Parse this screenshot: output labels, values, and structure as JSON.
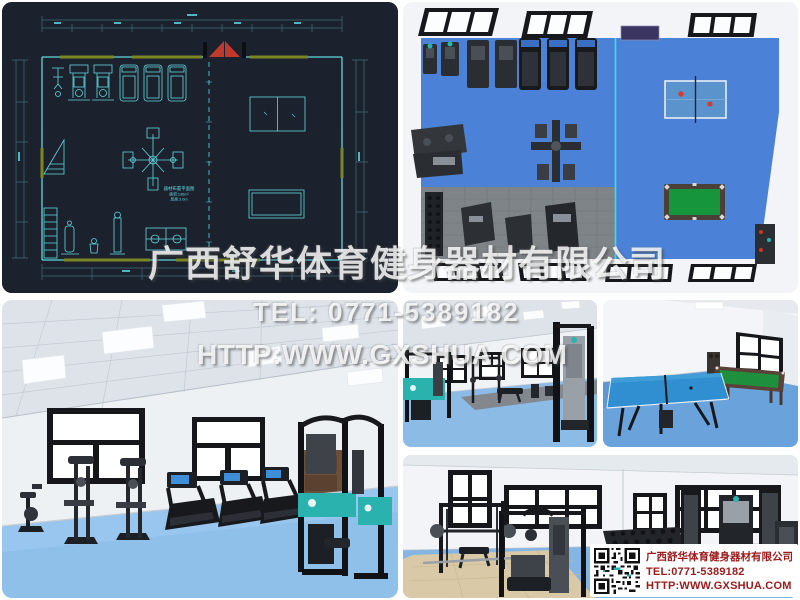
{
  "company": {
    "name": "广西舒华体育健身器材有限公司",
    "accent_teal": "#2ab2ae",
    "contact_red": "#9c1a1a"
  },
  "watermark": {
    "company": "广西舒华体育健身器材有限公司",
    "tel": "TEL: 0771-5389182",
    "url": "HTTP:WWW.GXSHUA.COM"
  },
  "contact_card": {
    "company": "广西舒华体育健身器材有限公司",
    "tel": "TEL:0771-5389182",
    "url": "HTTP:WWW.GXSHUA.COM",
    "qr_icon": "qr-code"
  },
  "floor_plan": {
    "background": "#1c222d",
    "line_color": "#62d6e0",
    "dim_line_color": "#3f6d78",
    "wall_accent_color": "#7b8722",
    "door_color": "#c0392b",
    "annotation_lines": [
      "器材布置平面图",
      "面积:136m²",
      "层高:3.0m"
    ]
  },
  "renders": {
    "floor_blue": "#4b82d8",
    "floor_light_blue": "#8fc0ea",
    "mat_gray": "#7f8488",
    "mat_tan": "#d9c9a6",
    "pool_green": "#1e8f3c",
    "tennis_blue": "#5b93cc",
    "divider_cyan": "#35e0e8"
  },
  "tiles": [
    {
      "name": "floor-plan",
      "alt": "CAD floor plan of gym equipment layout with dimension lines, treadmills, strength stations, table tennis and billiards tables"
    },
    {
      "name": "top-view-render",
      "alt": "Top-down 3D render of gym: blue floor, cardio row, multi-gym, gray mat area, table tennis table and green billiards table"
    },
    {
      "name": "cardio-room-render",
      "alt": "3D render of cardio room with exercise bike, two ellipticals, three treadmills and teal multi-gym by windows"
    },
    {
      "name": "strength-room-render",
      "alt": "3D render of strength room with teal multi-gym, squat rack, bench and cable machine on blue floor"
    },
    {
      "name": "games-room-render",
      "alt": "3D render of games room with blue table tennis table and billiards table by a window"
    },
    {
      "name": "free-weights-render",
      "alt": "3D render of free-weights room with smith machine, multi-gym, dumbbell rack and cable crossover"
    }
  ]
}
